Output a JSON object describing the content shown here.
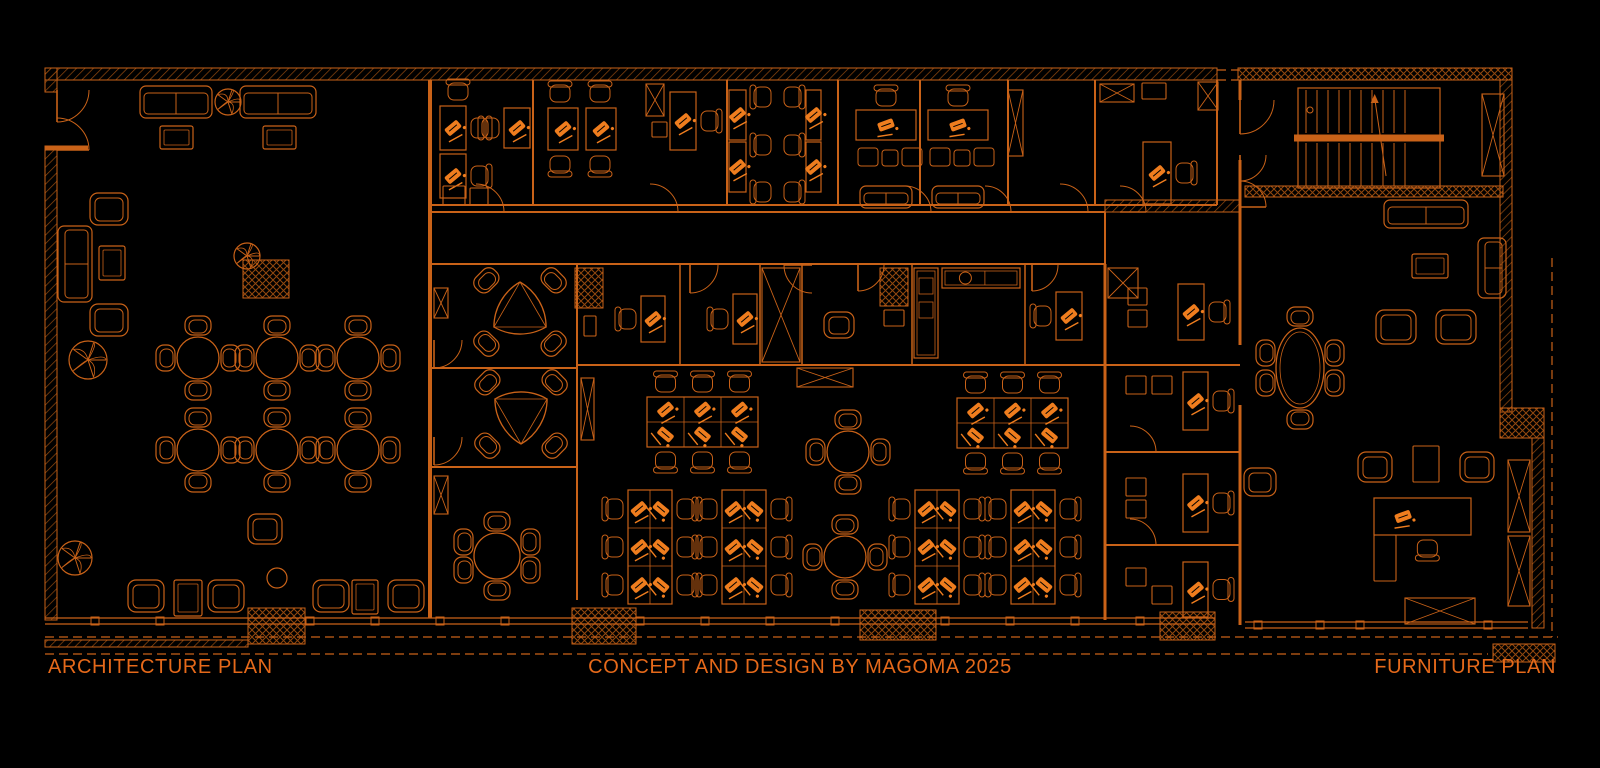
{
  "meta": {
    "width": 1600,
    "height": 768,
    "drawing_type": "architectural floor plan, CAD style, orange lines on black"
  },
  "colors": {
    "bg": "#000000",
    "line": "#c96218",
    "dim": "#94490f",
    "bright": "#ef7d1e",
    "text": "#e5691a"
  },
  "labels": {
    "left": "ARCHITECTURE PLAN",
    "center": "CONCEPT AND DESIGN BY MAGOMA 2025",
    "right": "FURNITURE PLAN"
  },
  "plan": {
    "walls": [
      [
        45,
        68,
        1172,
        12,
        "h"
      ],
      [
        1238,
        68,
        274,
        12,
        "c"
      ],
      [
        45,
        68,
        12,
        24,
        "h"
      ],
      [
        45,
        146,
        12,
        474,
        "h"
      ],
      [
        1500,
        80,
        12,
        332,
        "h"
      ],
      [
        1500,
        408,
        44,
        30,
        "c"
      ],
      [
        1532,
        438,
        12,
        190,
        "h"
      ],
      [
        1245,
        186,
        258,
        11,
        "c"
      ],
      [
        1105,
        200,
        135,
        12,
        "h"
      ],
      [
        45,
        640,
        203,
        7,
        "h"
      ],
      [
        575,
        268,
        28,
        40,
        "c"
      ],
      [
        880,
        268,
        28,
        38,
        "c"
      ],
      [
        243,
        260,
        46,
        38,
        "c"
      ],
      [
        248,
        608,
        57,
        36,
        "c"
      ],
      [
        572,
        608,
        64,
        36,
        "c"
      ],
      [
        860,
        610,
        76,
        30,
        "c"
      ],
      [
        1160,
        612,
        55,
        28,
        "c"
      ],
      [
        1493,
        644,
        62,
        18,
        "c"
      ]
    ],
    "lines": [
      [
        430,
        80,
        430,
        618,
        4,
        0
      ],
      [
        432,
        205,
        1217,
        205,
        2,
        0
      ],
      [
        432,
        212,
        1105,
        212,
        2,
        0
      ],
      [
        432,
        264,
        1105,
        264,
        2,
        0
      ],
      [
        1105,
        212,
        1105,
        264,
        2,
        0
      ],
      [
        533,
        80,
        533,
        205,
        2,
        0
      ],
      [
        727,
        80,
        727,
        205,
        2,
        0
      ],
      [
        838,
        80,
        838,
        205,
        2,
        0
      ],
      [
        920,
        80,
        920,
        205,
        2,
        0
      ],
      [
        1008,
        80,
        1008,
        205,
        2,
        0
      ],
      [
        1095,
        80,
        1095,
        205,
        2,
        0
      ],
      [
        1217,
        80,
        1217,
        205,
        2,
        0
      ],
      [
        1240,
        80,
        1240,
        100,
        3,
        0
      ],
      [
        1240,
        160,
        1240,
        345,
        3,
        0
      ],
      [
        1240,
        405,
        1240,
        625,
        3,
        0
      ],
      [
        1105,
        264,
        1105,
        620,
        3,
        0
      ],
      [
        577,
        265,
        577,
        600,
        2,
        0
      ],
      [
        432,
        368,
        577,
        368,
        2,
        0
      ],
      [
        432,
        467,
        577,
        467,
        2,
        0
      ],
      [
        577,
        365,
        1240,
        365,
        2,
        0
      ],
      [
        1105,
        452,
        1240,
        452,
        2,
        0
      ],
      [
        1105,
        545,
        1240,
        545,
        2,
        0
      ],
      [
        680,
        265,
        680,
        365,
        1.5,
        0
      ],
      [
        760,
        265,
        760,
        365,
        1.5,
        0
      ],
      [
        802,
        265,
        802,
        365,
        1.5,
        0
      ],
      [
        912,
        265,
        912,
        365,
        1.5,
        0
      ],
      [
        1025,
        265,
        1025,
        365,
        1.5,
        0
      ],
      [
        45,
        618,
        1215,
        618,
        1.2,
        0
      ],
      [
        45,
        624,
        1215,
        624,
        1.2,
        0
      ],
      [
        1245,
        622,
        1528,
        622,
        1.2,
        0
      ],
      [
        1245,
        628,
        1528,
        628,
        1.2,
        0
      ],
      [
        45,
        637,
        1558,
        637,
        1.2,
        1
      ],
      [
        45,
        654,
        1488,
        654,
        1.2,
        1
      ],
      [
        1552,
        258,
        1552,
        637,
        1.2,
        1
      ],
      [
        1217,
        70,
        1238,
        70,
        1.2,
        1
      ],
      [
        1217,
        80,
        1238,
        80,
        1.2,
        1
      ],
      [
        45,
        148,
        88,
        148,
        5,
        0
      ]
    ],
    "doors": [
      [
        57,
        90,
        32,
        0
      ],
      [
        57,
        150,
        32,
        -90
      ],
      [
        476,
        212,
        28,
        -90
      ],
      [
        650,
        212,
        28,
        -90
      ],
      [
        905,
        212,
        26,
        -90
      ],
      [
        985,
        212,
        26,
        -90
      ],
      [
        1060,
        212,
        28,
        -90
      ],
      [
        1120,
        212,
        26,
        -90
      ],
      [
        690,
        265,
        28,
        0
      ],
      [
        812,
        265,
        28,
        90
      ],
      [
        858,
        265,
        26,
        0
      ],
      [
        1032,
        265,
        26,
        0
      ],
      [
        434,
        340,
        28,
        0
      ],
      [
        434,
        437,
        28,
        0
      ],
      [
        1130,
        452,
        26,
        -90
      ],
      [
        1130,
        545,
        26,
        -90
      ],
      [
        1240,
        100,
        34,
        0
      ],
      [
        1240,
        155,
        26,
        0
      ],
      [
        1240,
        207,
        26,
        -90
      ]
    ],
    "mullions": [
      {
        "y": 621,
        "xs": [
          95,
          160,
          310,
          375,
          440,
          505,
          640,
          705,
          770,
          835,
          945,
          1010,
          1075,
          1140
        ]
      },
      {
        "y": 625,
        "xs": [
          1258,
          1320,
          1360,
          1488
        ]
      }
    ],
    "furniture": [
      {
        "t": "sofa",
        "x": 140,
        "y": 86,
        "w": 72,
        "h": 32
      },
      {
        "t": "sofa",
        "x": 240,
        "y": 86,
        "w": 76,
        "h": 32
      },
      {
        "t": "table",
        "x": 160,
        "y": 126,
        "w": 33,
        "h": 23
      },
      {
        "t": "table",
        "x": 263,
        "y": 126,
        "w": 33,
        "h": 23
      },
      {
        "t": "plant",
        "cx": 228,
        "cy": 102,
        "r": 13
      },
      {
        "t": "armchair",
        "x": 90,
        "y": 193,
        "w": 38,
        "h": 32
      },
      {
        "t": "sofa",
        "x": 58,
        "y": 226,
        "w": 34,
        "h": 76
      },
      {
        "t": "table",
        "x": 99,
        "y": 246,
        "w": 26,
        "h": 34
      },
      {
        "t": "armchair",
        "x": 90,
        "y": 304,
        "w": 38,
        "h": 32
      },
      {
        "t": "plant",
        "cx": 88,
        "cy": 360,
        "r": 19
      },
      {
        "t": "plant",
        "cx": 247,
        "cy": 256,
        "r": 13
      },
      {
        "t": "round4",
        "cx": 198,
        "cy": 358,
        "r": 21
      },
      {
        "t": "round4",
        "cx": 277,
        "cy": 358,
        "r": 21
      },
      {
        "t": "round4",
        "cx": 358,
        "cy": 358,
        "r": 21
      },
      {
        "t": "round4",
        "cx": 198,
        "cy": 450,
        "r": 21
      },
      {
        "t": "round4",
        "cx": 277,
        "cy": 450,
        "r": 21
      },
      {
        "t": "round4",
        "cx": 358,
        "cy": 450,
        "r": 21
      },
      {
        "t": "armchair",
        "x": 128,
        "y": 580,
        "w": 36,
        "h": 32
      },
      {
        "t": "table",
        "x": 174,
        "y": 580,
        "w": 28,
        "h": 36
      },
      {
        "t": "armchair",
        "x": 208,
        "y": 580,
        "w": 36,
        "h": 32
      },
      {
        "t": "round0",
        "cx": 277,
        "cy": 578,
        "r": 10
      },
      {
        "t": "armchair",
        "x": 313,
        "y": 580,
        "w": 36,
        "h": 32
      },
      {
        "t": "table",
        "x": 352,
        "y": 580,
        "w": 26,
        "h": 34
      },
      {
        "t": "armchair",
        "x": 388,
        "y": 580,
        "w": 36,
        "h": 32
      },
      {
        "t": "armchair",
        "x": 248,
        "y": 514,
        "w": 34,
        "h": 30
      },
      {
        "t": "plant",
        "cx": 75,
        "cy": 558,
        "r": 17
      },
      {
        "t": "desk",
        "x": 440,
        "y": 106,
        "w": 26,
        "h": 44,
        "chair": "E"
      },
      {
        "t": "desk",
        "x": 440,
        "y": 154,
        "w": 26,
        "h": 44,
        "chair": "E"
      },
      {
        "t": "chair",
        "cx": 458,
        "cy": 91,
        "rot": 0
      },
      {
        "t": "sq",
        "x": 443,
        "y": 186,
        "w": 22,
        "h": 19
      },
      {
        "t": "sq",
        "x": 470,
        "y": 188,
        "w": 18,
        "h": 17
      },
      {
        "t": "desk",
        "x": 504,
        "y": 108,
        "w": 26,
        "h": 40,
        "chair": "W"
      },
      {
        "t": "chair",
        "cx": 560,
        "cy": 93,
        "rot": 0
      },
      {
        "t": "chair",
        "cx": 600,
        "cy": 93,
        "rot": 0
      },
      {
        "t": "desk",
        "x": 548,
        "y": 108,
        "w": 30,
        "h": 42
      },
      {
        "t": "desk",
        "x": 586,
        "y": 108,
        "w": 30,
        "h": 42
      },
      {
        "t": "chair",
        "cx": 560,
        "cy": 165,
        "rot": 180
      },
      {
        "t": "chair",
        "cx": 600,
        "cy": 165,
        "rot": 180
      },
      {
        "t": "desk",
        "x": 670,
        "y": 92,
        "w": 26,
        "h": 58,
        "chair": "E"
      },
      {
        "t": "rectX",
        "x": 646,
        "y": 84,
        "w": 18,
        "h": 32
      },
      {
        "t": "sq",
        "x": 652,
        "y": 122,
        "w": 15,
        "h": 15
      },
      {
        "t": "desk",
        "x": 729,
        "y": 90,
        "w": 17,
        "h": 50
      },
      {
        "t": "desk",
        "x": 729,
        "y": 142,
        "w": 17,
        "h": 50
      },
      {
        "t": "chair",
        "cx": 762,
        "cy": 97,
        "rot": -90
      },
      {
        "t": "chair",
        "cx": 793,
        "cy": 97,
        "rot": 90
      },
      {
        "t": "chair",
        "cx": 762,
        "cy": 145,
        "rot": -90
      },
      {
        "t": "chair",
        "cx": 793,
        "cy": 145,
        "rot": 90
      },
      {
        "t": "chair",
        "cx": 762,
        "cy": 192,
        "rot": -90
      },
      {
        "t": "chair",
        "cx": 793,
        "cy": 192,
        "rot": 90
      },
      {
        "t": "desk",
        "x": 806,
        "y": 90,
        "w": 15,
        "h": 50
      },
      {
        "t": "desk",
        "x": 806,
        "y": 142,
        "w": 15,
        "h": 50
      },
      {
        "t": "deskSuite",
        "x": 856,
        "y": 110
      },
      {
        "t": "deskSuite",
        "x": 928,
        "y": 110
      },
      {
        "t": "rectX",
        "x": 1008,
        "y": 90,
        "w": 15,
        "h": 66
      },
      {
        "t": "rectX",
        "x": 1100,
        "y": 84,
        "w": 34,
        "h": 18
      },
      {
        "t": "sq",
        "x": 1142,
        "y": 83,
        "w": 24,
        "h": 16
      },
      {
        "t": "rectX",
        "x": 1198,
        "y": 82,
        "w": 20,
        "h": 28
      },
      {
        "t": "desk",
        "x": 1143,
        "y": 142,
        "w": 28,
        "h": 62,
        "chair": "E"
      },
      {
        "t": "desk",
        "x": 641,
        "y": 296,
        "w": 24,
        "h": 46,
        "chair": "W"
      },
      {
        "t": "desk",
        "x": 733,
        "y": 294,
        "w": 24,
        "h": 50,
        "chair": "W"
      },
      {
        "t": "rectX",
        "x": 762,
        "y": 268,
        "w": 38,
        "h": 94
      },
      {
        "t": "armchair",
        "x": 824,
        "y": 312,
        "w": 30,
        "h": 26
      },
      {
        "t": "sq",
        "x": 884,
        "y": 310,
        "w": 20,
        "h": 16
      },
      {
        "t": "counter",
        "x": 914,
        "y": 268,
        "w": 24,
        "h": 90
      },
      {
        "t": "counter",
        "x": 942,
        "y": 268,
        "w": 78,
        "h": 20
      },
      {
        "t": "desk",
        "x": 1056,
        "y": 292,
        "w": 26,
        "h": 48,
        "chair": "W"
      },
      {
        "t": "rectX",
        "x": 1108,
        "y": 268,
        "w": 30,
        "h": 30
      },
      {
        "t": "desk",
        "x": 1178,
        "y": 284,
        "w": 26,
        "h": 56,
        "chair": "E"
      },
      {
        "t": "sq",
        "x": 1128,
        "y": 288,
        "w": 19,
        "h": 17
      },
      {
        "t": "sq",
        "x": 1128,
        "y": 310,
        "w": 19,
        "h": 17
      },
      {
        "t": "clusterH",
        "x": 647,
        "y": 397,
        "cols": 3,
        "rows": 2,
        "cw": 37,
        "ch": 25
      },
      {
        "t": "clusterH",
        "x": 957,
        "y": 398,
        "cols": 3,
        "rows": 2,
        "cw": 37,
        "ch": 25
      },
      {
        "t": "rectX",
        "x": 797,
        "y": 368,
        "w": 56,
        "h": 19
      },
      {
        "t": "round4",
        "cx": 848,
        "cy": 452,
        "r": 21
      },
      {
        "t": "round4",
        "cx": 845,
        "cy": 557,
        "r": 21
      },
      {
        "t": "clusterV",
        "x": 628,
        "y": 490,
        "cols": 2,
        "rows": 3,
        "cw": 22,
        "ch": 38
      },
      {
        "t": "clusterV",
        "x": 722,
        "y": 490,
        "cols": 2,
        "rows": 3,
        "cw": 22,
        "ch": 38
      },
      {
        "t": "clusterV",
        "x": 915,
        "y": 490,
        "cols": 2,
        "rows": 3,
        "cw": 22,
        "ch": 38
      },
      {
        "t": "clusterV",
        "x": 1011,
        "y": 490,
        "cols": 2,
        "rows": 3,
        "cw": 22,
        "ch": 38
      },
      {
        "t": "tri4",
        "cx": 520,
        "cy": 312,
        "r": 30,
        "flip": 0
      },
      {
        "t": "tri4",
        "cx": 521,
        "cy": 414,
        "r": 30,
        "flip": 1
      },
      {
        "t": "round6",
        "cx": 497,
        "cy": 556,
        "r": 23
      },
      {
        "t": "rectX",
        "x": 434,
        "y": 288,
        "w": 14,
        "h": 30
      },
      {
        "t": "rectX",
        "x": 434,
        "y": 476,
        "w": 14,
        "h": 38
      },
      {
        "t": "rectX",
        "x": 581,
        "y": 378,
        "w": 13,
        "h": 62
      },
      {
        "t": "sq",
        "x": 584,
        "y": 316,
        "w": 12,
        "h": 20
      },
      {
        "t": "sq",
        "x": 1126,
        "y": 376,
        "w": 20,
        "h": 18
      },
      {
        "t": "sq",
        "x": 1152,
        "y": 376,
        "w": 20,
        "h": 18
      },
      {
        "t": "desk",
        "x": 1183,
        "y": 372,
        "w": 25,
        "h": 58,
        "chair": "E"
      },
      {
        "t": "sq",
        "x": 1126,
        "y": 478,
        "w": 20,
        "h": 18
      },
      {
        "t": "sq",
        "x": 1126,
        "y": 500,
        "w": 20,
        "h": 18
      },
      {
        "t": "desk",
        "x": 1183,
        "y": 474,
        "w": 25,
        "h": 58,
        "chair": "E"
      },
      {
        "t": "sq",
        "x": 1126,
        "y": 568,
        "w": 20,
        "h": 18
      },
      {
        "t": "sq",
        "x": 1152,
        "y": 586,
        "w": 20,
        "h": 18
      },
      {
        "t": "desk",
        "x": 1183,
        "y": 562,
        "w": 25,
        "h": 55,
        "chair": "E"
      },
      {
        "t": "stairs",
        "x": 1298,
        "y": 88,
        "w": 142,
        "h": 100
      },
      {
        "t": "rectX",
        "x": 1482,
        "y": 94,
        "w": 22,
        "h": 82
      },
      {
        "t": "sofa",
        "x": 1384,
        "y": 200,
        "w": 84,
        "h": 28
      },
      {
        "t": "table",
        "x": 1412,
        "y": 254,
        "w": 36,
        "h": 24
      },
      {
        "t": "sofa",
        "x": 1478,
        "y": 238,
        "w": 28,
        "h": 60
      },
      {
        "t": "armchair",
        "x": 1376,
        "y": 310,
        "w": 40,
        "h": 34
      },
      {
        "t": "armchair",
        "x": 1436,
        "y": 310,
        "w": 40,
        "h": 34
      },
      {
        "t": "oval6",
        "cx": 1300,
        "cy": 368,
        "rx": 24,
        "ry": 40
      },
      {
        "t": "armchair",
        "x": 1244,
        "y": 468,
        "w": 32,
        "h": 28
      },
      {
        "t": "armchair",
        "x": 1358,
        "y": 452,
        "w": 34,
        "h": 30
      },
      {
        "t": "sq",
        "x": 1413,
        "y": 446,
        "w": 26,
        "h": 36
      },
      {
        "t": "armchair",
        "x": 1460,
        "y": 452,
        "w": 34,
        "h": 30
      },
      {
        "t": "desk",
        "x": 1374,
        "y": 498,
        "w": 97,
        "h": 37,
        "chair": "S"
      },
      {
        "t": "sq",
        "x": 1374,
        "y": 535,
        "w": 22,
        "h": 46
      },
      {
        "t": "rectX",
        "x": 1508,
        "y": 460,
        "w": 22,
        "h": 72
      },
      {
        "t": "rectX",
        "x": 1508,
        "y": 536,
        "w": 22,
        "h": 70
      },
      {
        "t": "rectX",
        "x": 1405,
        "y": 598,
        "w": 70,
        "h": 26
      }
    ]
  }
}
